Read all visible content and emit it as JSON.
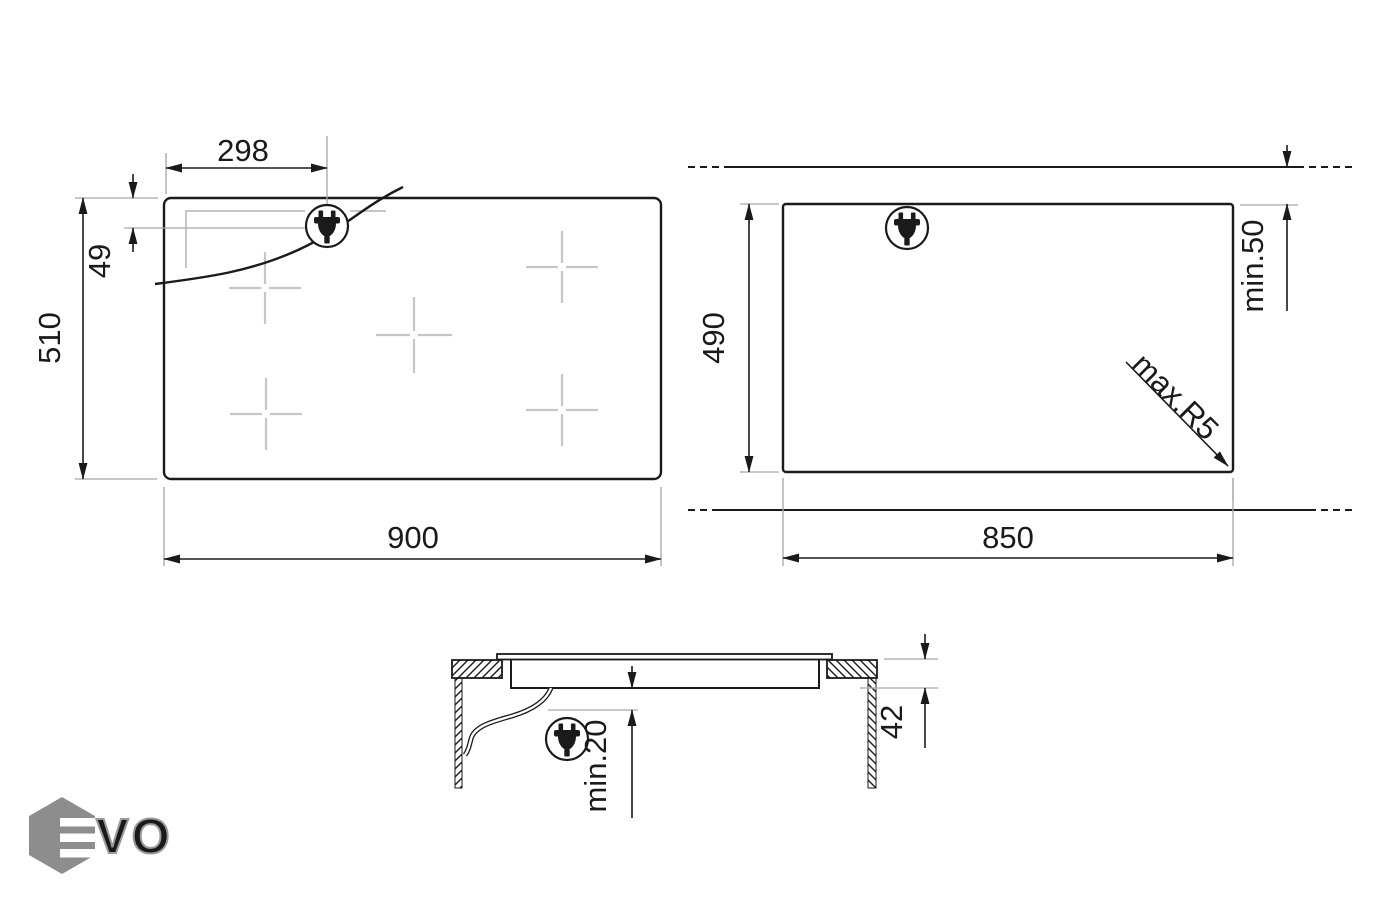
{
  "logo": {
    "brand": "EVO",
    "outline_letters": "VO"
  },
  "views": {
    "top": {
      "name": "hob top view",
      "cooking_zones": 5,
      "dims": {
        "width": "900",
        "depth": "510",
        "plug_offset_x": "298",
        "plug_offset_y": "49"
      }
    },
    "cutout": {
      "name": "worktop cutout view",
      "dims": {
        "width": "850",
        "depth": "490",
        "rear_clearance": "min.50",
        "corner_radius": "max.R5"
      }
    },
    "side": {
      "name": "side profile view",
      "dims": {
        "build_in_height": "42",
        "clearance_below": "min.20"
      }
    }
  },
  "icons": {
    "plug": "power-plug-icon",
    "plug_count": 3
  },
  "colors": {
    "line": "#1a1a1a",
    "extension_line": "#a6a6a6",
    "zone_cross": "#c6c6c6",
    "hidden_cutout_line": "#b4b4b4",
    "logo_grey": "#8d8d8d"
  }
}
